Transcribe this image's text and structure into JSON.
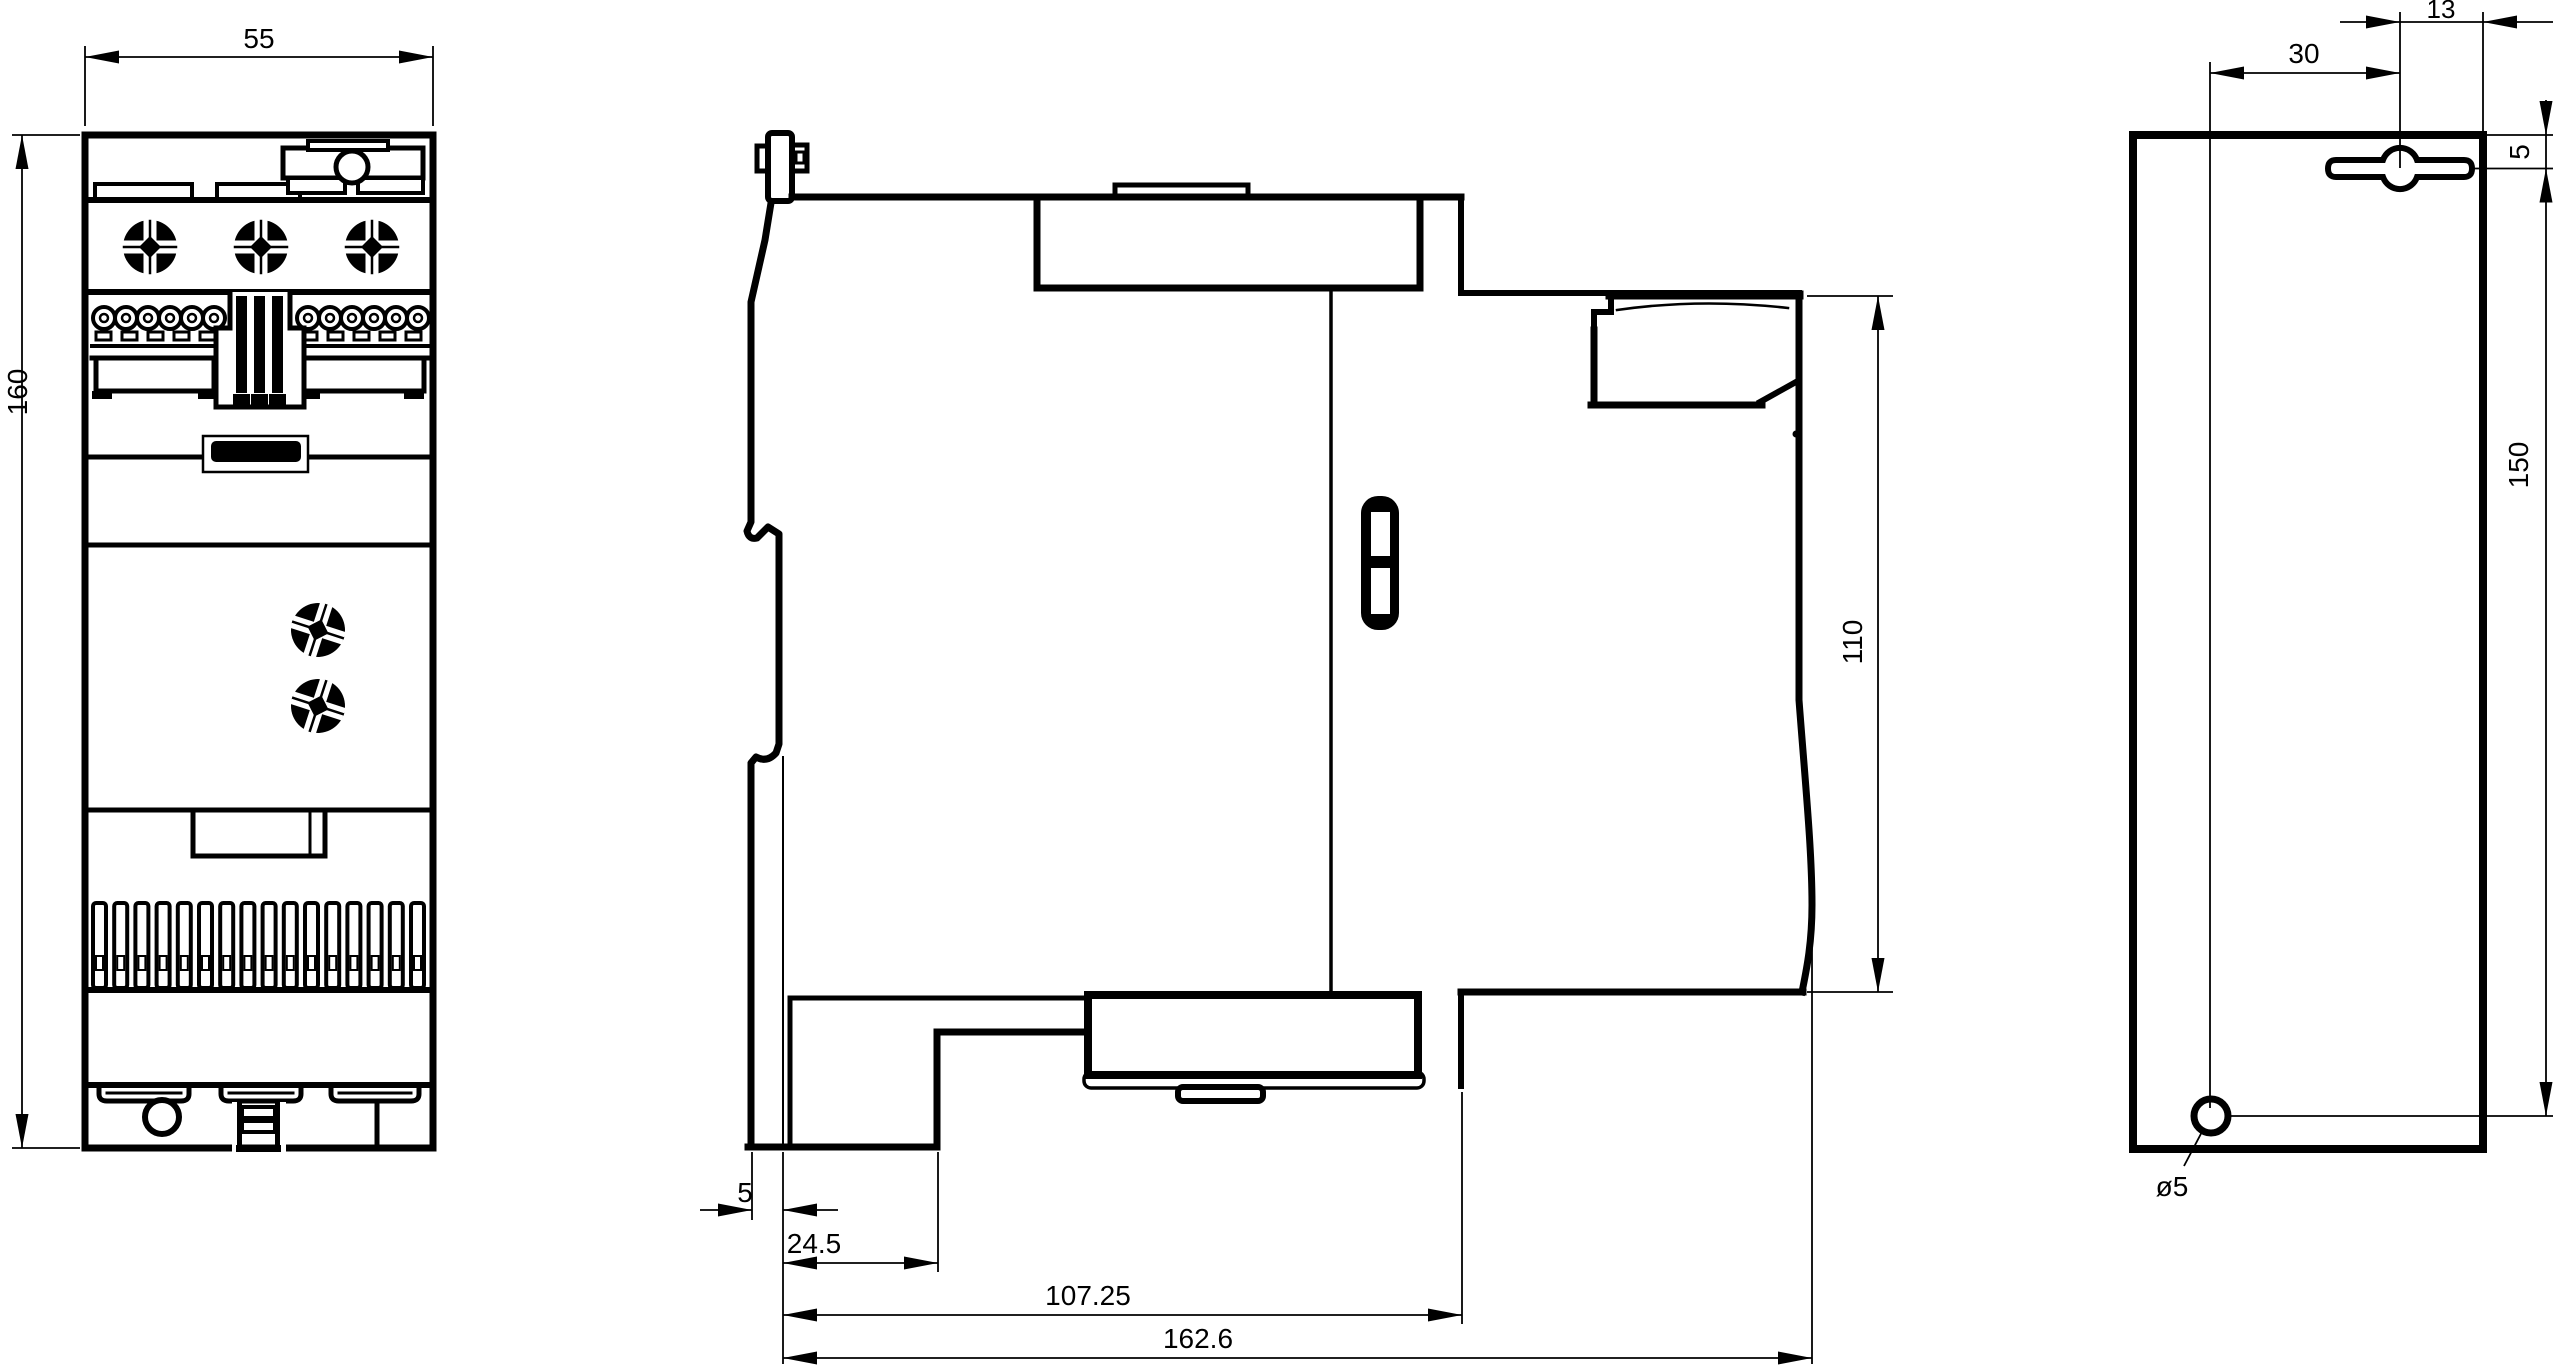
{
  "drawing": {
    "type": "technical-dimension-drawing",
    "background": "#ffffff",
    "line_color": "#000000",
    "views": [
      {
        "id": "front",
        "label": "front-view"
      },
      {
        "id": "side",
        "label": "side-view"
      },
      {
        "id": "rear",
        "label": "rear-mounting-view"
      }
    ],
    "dimensions": {
      "front": {
        "width": "55",
        "height": "160"
      },
      "side": {
        "front_offset": "5",
        "vent_depth": "24.5",
        "body_depth": "107.25",
        "total_depth": "162.6",
        "rear_height": "110"
      },
      "rear": {
        "keyhole_to_edge": "13",
        "hole_offset_h": "30",
        "keyhole_from_top": "5",
        "hole_spacing_v": "150",
        "hole_diameter": "ø5"
      }
    }
  }
}
